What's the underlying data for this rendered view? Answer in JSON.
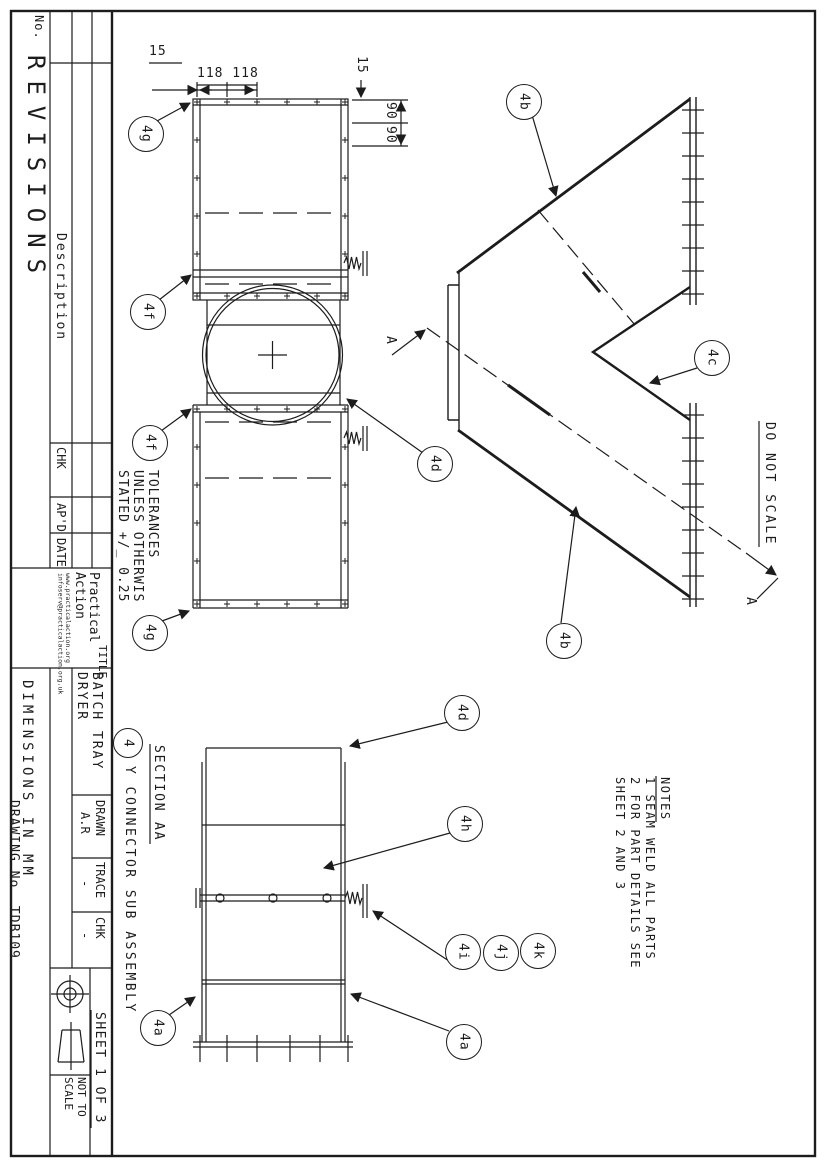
{
  "revisions_table": {
    "no_label": "No.",
    "table_title": "REVISIONS",
    "description_label": "Description",
    "chk_label": "CHK",
    "apd_label": "AP'D",
    "date_label": "DATE"
  },
  "org": {
    "name_line1": "Practical",
    "name_line2": "Action",
    "website": "www.practicalaction.org",
    "email": "infoserv@practicalaction.org.uk"
  },
  "tolerances_note": {
    "line1": "TOLERANCES",
    "line2": "UNLESS OTHERWIS",
    "line3": "STATED +/_ 0.25"
  },
  "title_block": {
    "title_label": "TITLE",
    "title_line1": "BATCH TRAY",
    "title_line2": "DRYER",
    "units_note": "DIMENSIONS IN MM",
    "drawn_label": "DRAWN",
    "drawn_value": "A.R",
    "trace_label": "TRACE",
    "trace_value": "-",
    "chk_label": "CHK",
    "chk_value": "-",
    "drawing_no": "DRAWING No. TDB109",
    "sheet_label": "SHEET 1 OF 3",
    "scale_line1": "NOT TO",
    "scale_line2": "SCALE"
  },
  "annotations": {
    "do_not_scale": "DO NOT SCALE",
    "section_title": "SECTION AA",
    "assembly_number": "4",
    "assembly_title": "Y CONNECTOR SUB ASSEMBLY",
    "section_arrow_label": "A"
  },
  "notes": {
    "title": "NOTES",
    "line1": "1 SEAM WELD ALL PARTS",
    "line2": "2 FOR PART DETAILS SEE",
    "line3": "SHEET 2 AND 3"
  },
  "dimensions": {
    "top_left_offset": "15",
    "top_spacing": "118 118",
    "right_offset": "15",
    "right_spacing_1": "90",
    "right_spacing_2": "90"
  },
  "balloons": [
    {
      "label": "4g"
    },
    {
      "label": "4f"
    },
    {
      "label": "4f"
    },
    {
      "label": "4g"
    },
    {
      "label": "4d"
    },
    {
      "label": "4b"
    },
    {
      "label": "4c"
    },
    {
      "label": "4b"
    },
    {
      "label": "4d"
    },
    {
      "label": "4h"
    },
    {
      "label": "4i"
    },
    {
      "label": "4j"
    },
    {
      "label": "4k"
    },
    {
      "label": "4a"
    },
    {
      "label": "4a"
    }
  ]
}
